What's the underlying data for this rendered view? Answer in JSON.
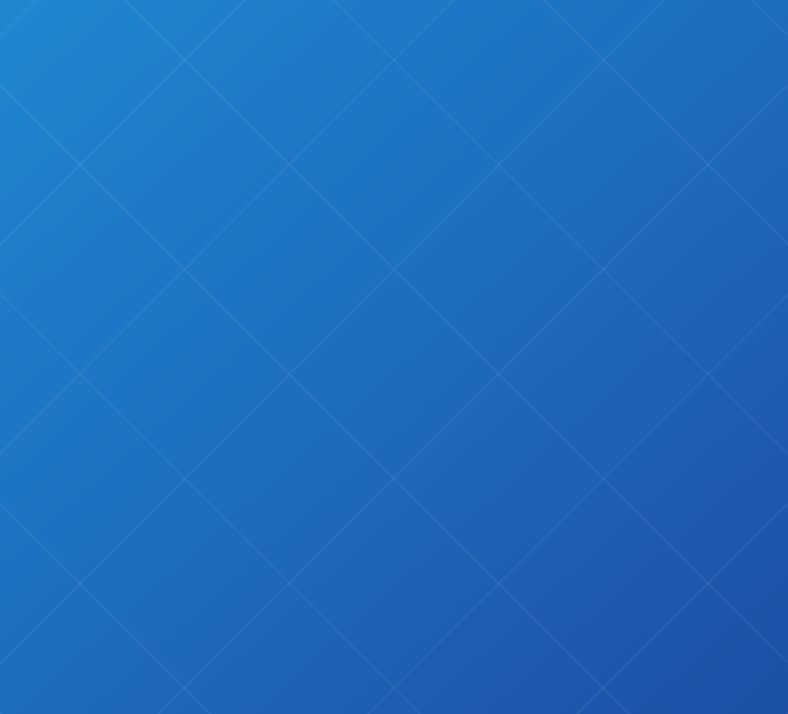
{
  "header": {
    "title": "2 BHK",
    "subtitle": "APARTMENT",
    "net_area_label": "NET AREA:",
    "net_area_value": "1093 SQFT."
  },
  "palette": {
    "background_top": "#1f87d1",
    "background_bottom": "#1c4fa6",
    "title_gold": "#cfa161",
    "subtitle_gold": "#c9a160",
    "net_area_white": "#ffffff",
    "wall_top": "#f8f6f1",
    "wall_light": "#e8e1d4",
    "wall_shadow": "#b4aa9d",
    "floor_wood": "#d8cec0",
    "terrace_wood": "#d2c6b6",
    "plank_line": "#b3a492",
    "plinth_black": "#0c0c10",
    "curtain_orange": "#d65f31",
    "sofa_tan": "#c09a6f",
    "bed_dark": "#3d4149",
    "plant_green": "#44603c",
    "glass_dark": "#16202a",
    "tv_screen_teal": "#2f9055",
    "lamp_glow": "#ffc277"
  },
  "floorplan": {
    "type": "3d-isometric-cutaway",
    "rooms": [
      "master-bedroom",
      "bedroom-2",
      "bathroom-1",
      "bathroom-2",
      "kitchen",
      "living-dining",
      "balcony",
      "terrace",
      "entrance"
    ],
    "furniture": [
      "master-bed",
      "bed-2",
      "wardrobe",
      "orange-curtains",
      "corner-windows",
      "louver-screen",
      "bathtub",
      "shower-enclosure",
      "vanity-mirror",
      "arch-niche",
      "toilet",
      "kitchen-island",
      "gas-hob",
      "sink-counter",
      "refrigerator",
      "tv-wall",
      "tv-console",
      "dining-table",
      "dining-chairs",
      "armchair",
      "sofa",
      "entrance-door",
      "balcony-plants",
      "awning",
      "ac-units",
      "wall-art-frames",
      "terrace-parapet",
      "floor-lamp-glows"
    ]
  }
}
